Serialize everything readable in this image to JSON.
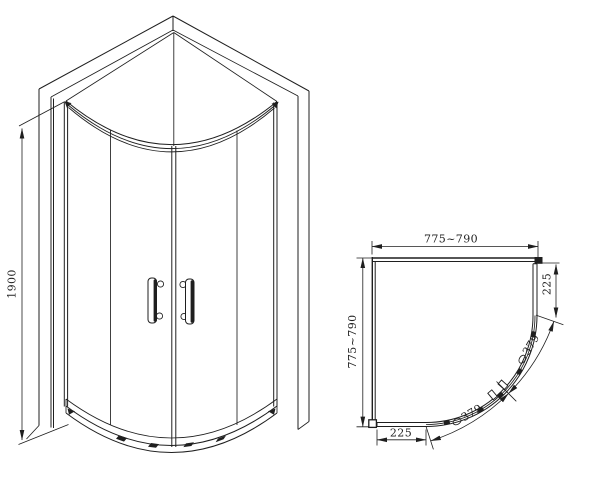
{
  "background": "#ffffff",
  "line_color": "#1f1f1f",
  "elevation": {
    "height_dim": "1900"
  },
  "plan": {
    "width_dim": "775~790",
    "depth_dim": "775~790",
    "right_side_dim": "225",
    "bottom_side_dim": "225",
    "upper_arc_dim": "379",
    "lower_arc_dim": "379"
  }
}
